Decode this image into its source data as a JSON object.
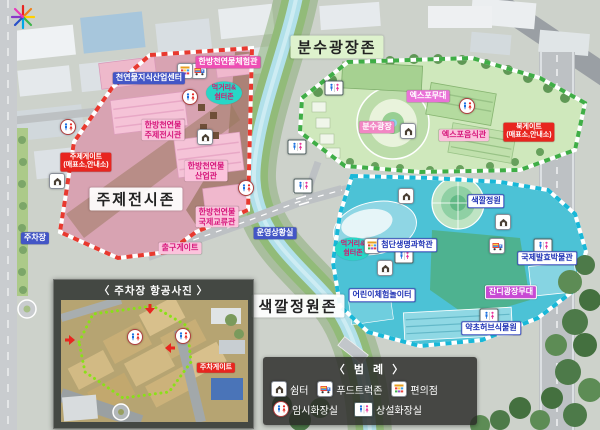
{
  "zones": {
    "theme": {
      "title": "주제전시존",
      "knowledge_center": "천연물지식산업센터",
      "experience_hall": "한방천연물체험관",
      "theme_hall_l1": "한방천연물",
      "theme_hall_l2": "주제전시관",
      "industry_hall_l1": "한방천연물",
      "industry_hall_l2": "산업관",
      "intl_hall_l1": "한방천연물",
      "intl_hall_l2": "국제교류관",
      "theme_gate_l1": "주제게이트",
      "theme_gate_l2": "(매표소,안내소)",
      "exit_gate": "출구게이트",
      "ops_room": "운영상황실"
    },
    "fountain": {
      "title": "분수광장존",
      "stage": "엑스포무대",
      "plaza": "분수광장",
      "food_hall": "엑스포음식관",
      "north_gate_l1": "북게이트",
      "north_gate_l2": "(매표소,안내소)"
    },
    "garden": {
      "title": "색깔정원존",
      "color_garden": "색깔정원",
      "science_hall": "첨단생명과학관",
      "ferment_museum": "국제발효박물관",
      "lawn_stage": "잔디광장무대",
      "kids_playground": "어린이체험놀이터",
      "herb_garden": "약초허브식물원"
    }
  },
  "food_rest_zone": {
    "l1": "먹거리&",
    "l2": "쉼터존"
  },
  "roadside": {
    "parking_label": "주차장"
  },
  "parking_photo": {
    "title": "〈 주차장 항공사진 〉",
    "gate": "주차게이트"
  },
  "legend": {
    "title": "〈 범 례 〉",
    "shelter": "쉼터",
    "food_truck": "푸드트럭존",
    "store": "편의점",
    "temp_toilet": "임시화장실",
    "perm_toilet": "상설화장실"
  },
  "colors": {
    "theme_zone_border": "#e8392f",
    "fountain_zone_border": "#3fae46",
    "garden_zone_border": "#18b8d8",
    "gate_label_red": "#e8251f",
    "info_label_blue": "#4356c6",
    "pink_label": "#fbc3dc",
    "food_rest_teal": "#28d6c6"
  }
}
